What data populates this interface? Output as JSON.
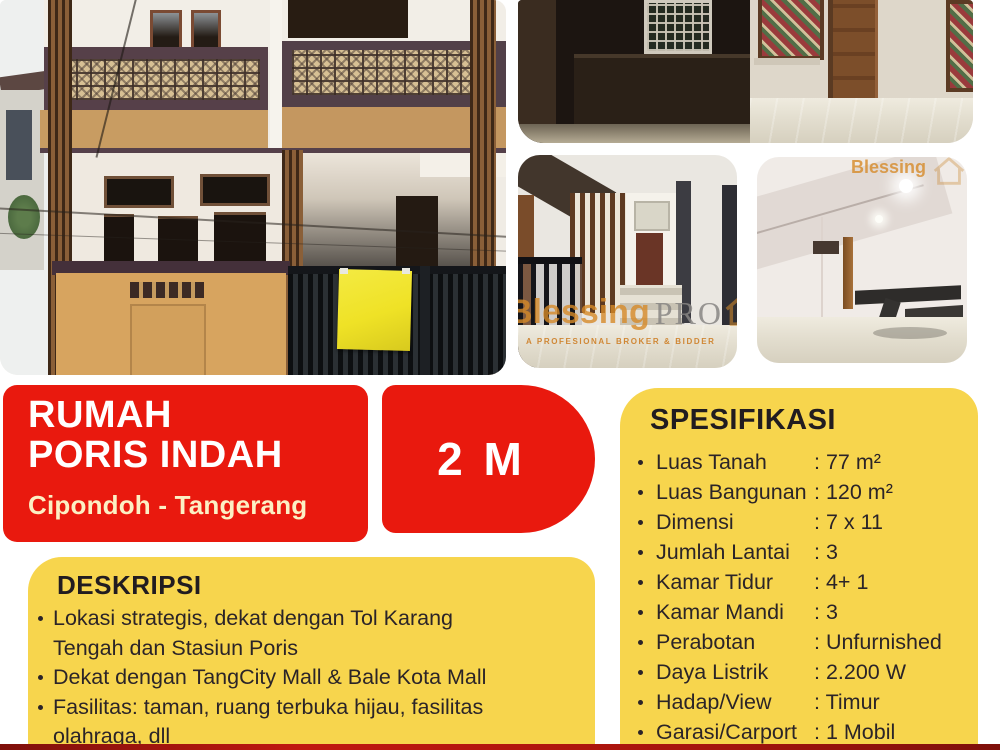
{
  "listing": {
    "title_line1": "RUMAH",
    "title_line2": "PORIS INDAH",
    "location": "Cipondoh - Tangerang",
    "price": "2 M"
  },
  "deskripsi": {
    "heading": "DESKRIPSI",
    "items": [
      "Lokasi strategis, dekat dengan Tol Karang\nTengah dan Stasiun Poris",
      "Dekat dengan TangCity Mall & Bale Kota Mall",
      "Fasilitas: taman, ruang terbuka hijau, fasilitas\nolahraga, dll"
    ]
  },
  "spesifikasi": {
    "heading": "SPESIFIKASI",
    "rows": [
      {
        "label": "Luas Tanah",
        "value": "77 m²"
      },
      {
        "label": "Luas Bangunan",
        "value": "120 m²"
      },
      {
        "label": "Dimensi",
        "value": "7 x 11"
      },
      {
        "label": "Jumlah Lantai",
        "value": "3"
      },
      {
        "label": "Kamar Tidur",
        "value": "4+ 1"
      },
      {
        "label": "Kamar Mandi",
        "value": "3"
      },
      {
        "label": "Perabotan",
        "value": "Unfurnished"
      },
      {
        "label": "Daya Listrik",
        "value": "2.200 W"
      },
      {
        "label": "Hadap/View",
        "value": "Timur"
      },
      {
        "label": "Garasi/Carport",
        "value": "1 Mobil"
      }
    ]
  },
  "watermarks": {
    "brand": "Blessing",
    "brand_suffix": "PRO",
    "tagline": "A PROFESIONAL BROKER & BIDDER",
    "corner_brand": "Blessing"
  },
  "colors": {
    "red_accent": "#e9190e",
    "yellow_card": "#f7d54d",
    "banner_yellow": "#f0e63c",
    "text_dark": "#2b2428",
    "subtitle_cream": "#fcf0c4",
    "watermark_orange": "#d68a28"
  }
}
